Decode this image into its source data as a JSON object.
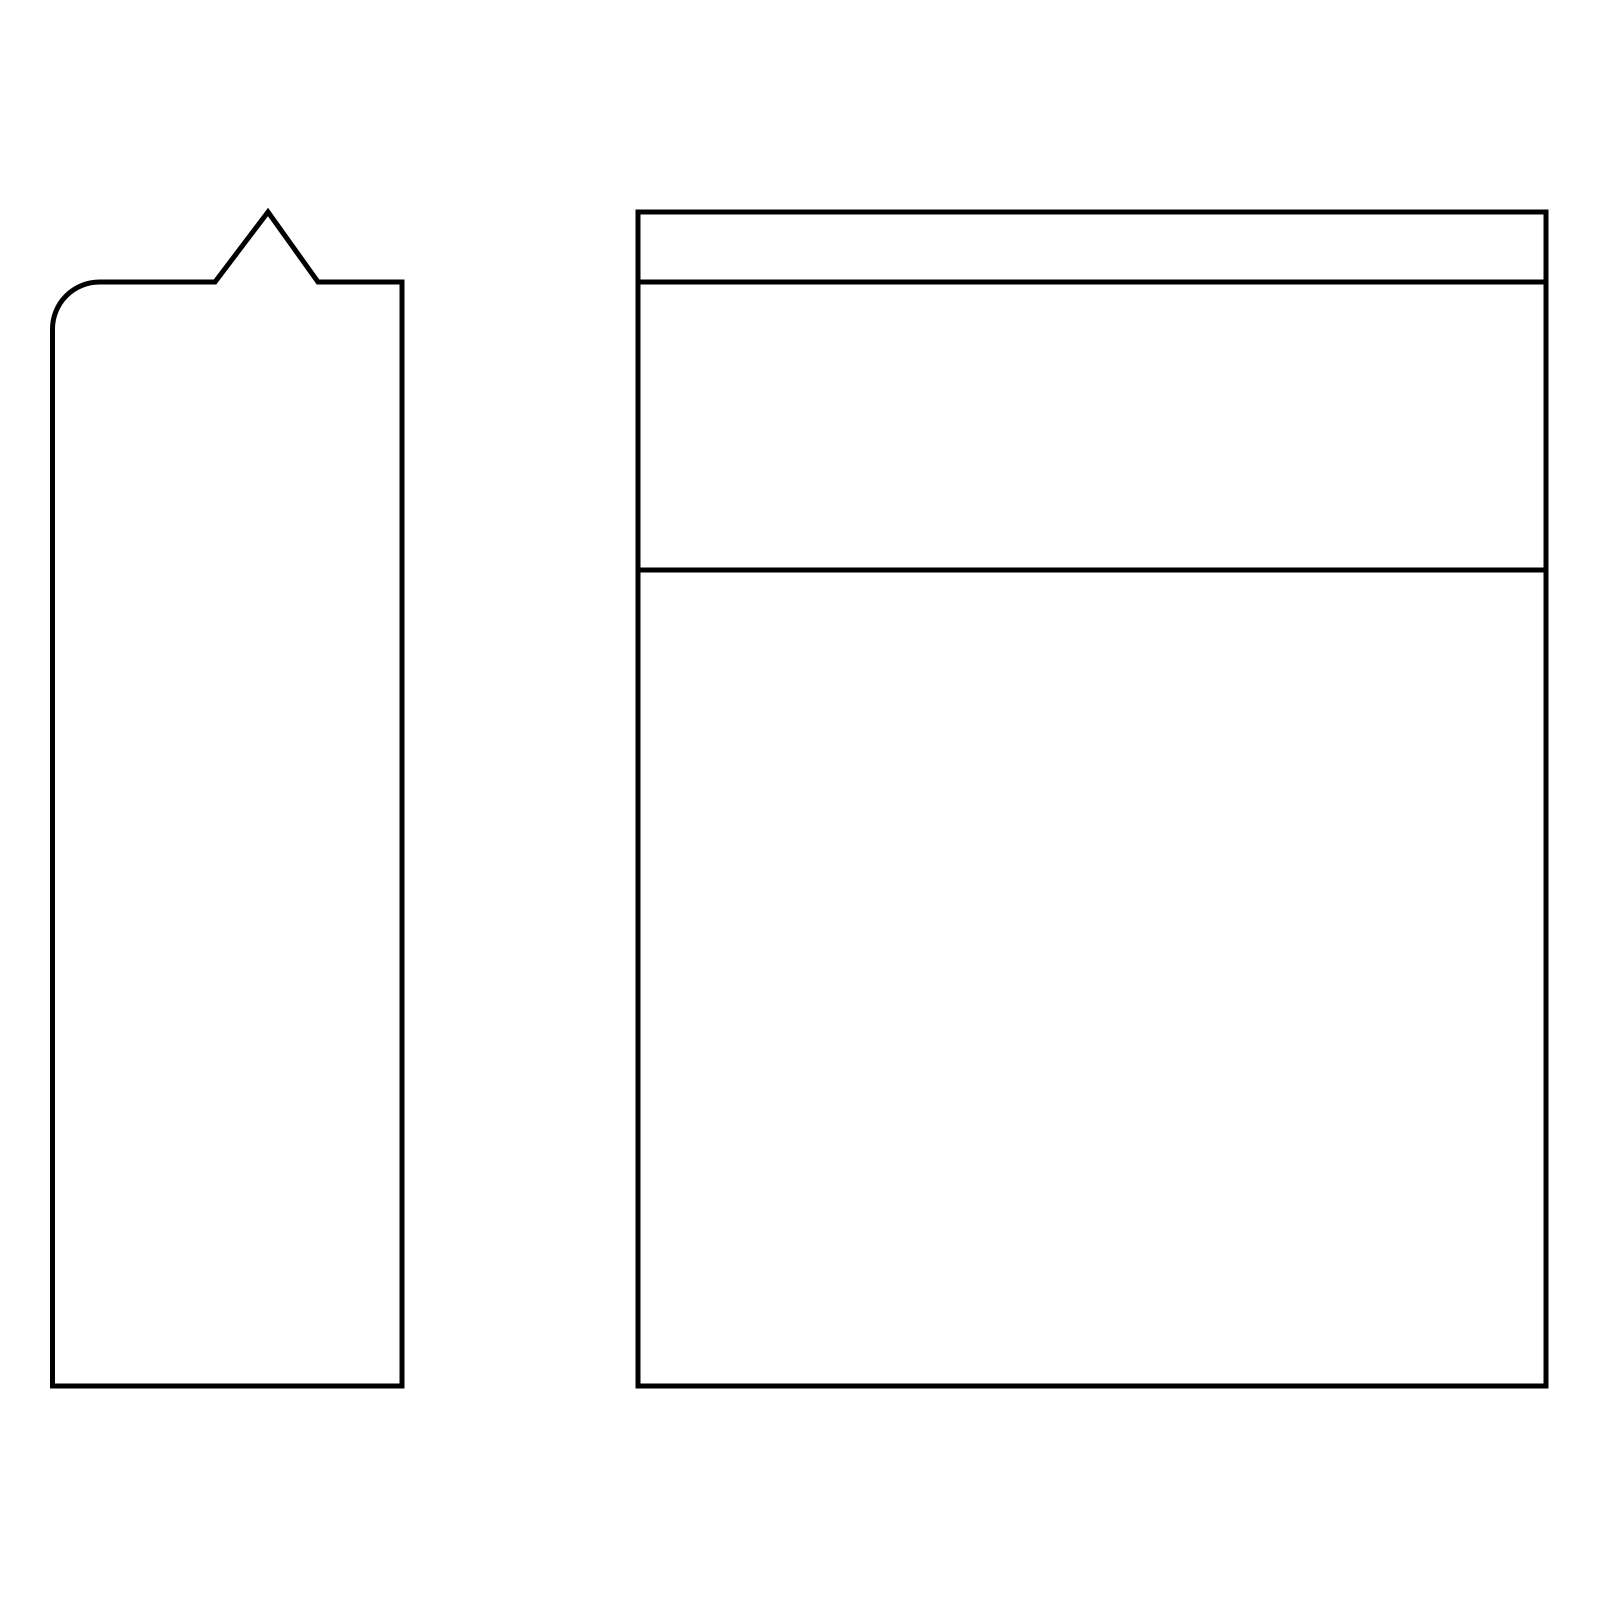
{
  "canvas": {
    "width": 1600,
    "height": 1600,
    "background": "#ffffff"
  },
  "drawing": {
    "stroke_color": "#000000",
    "stroke_width": 5,
    "fill": "none",
    "shapes": [
      {
        "id": "notched-tall-panel",
        "type": "notched_panel",
        "description": "tall narrow panel, rounded top-left corner, triangular peak notch on top edge",
        "left": 52.5,
        "top": 282,
        "right": 402,
        "bottom": 1386,
        "top_left_corner_radius": 47,
        "notch": {
          "base_start_x": 215,
          "apex_x": 268,
          "apex_y": 212,
          "base_end_x": 318
        }
      },
      {
        "id": "divided-rectangle",
        "type": "divided_rect",
        "description": "large rectangle split into three horizontal bands by two full-width divider lines",
        "left": 638,
        "top": 212,
        "right": 1546,
        "bottom": 1386,
        "divider_ys": [
          282,
          570
        ]
      }
    ]
  }
}
